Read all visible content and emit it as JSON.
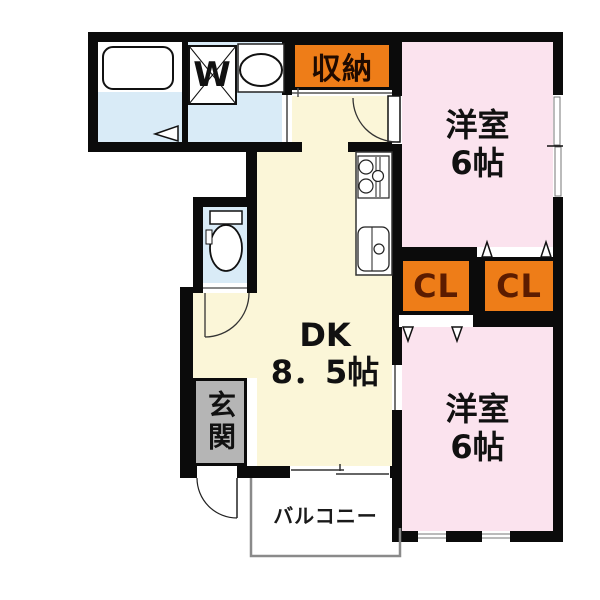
{
  "floorplan": {
    "type": "japanese-apartment-floorplan",
    "colors": {
      "wall": "#0b0b0b",
      "dk_floor": "#fbf6d8",
      "bedroom_floor": "#fbe3ee",
      "wet_area_floor": "#d9ebf7",
      "closet_fill": "#ee7d18",
      "closet_text": "#5c1c00",
      "entrance_fill": "#b5b5b5",
      "balcony_line": "#8a8a8a"
    },
    "rooms": {
      "storage": {
        "label": "収納"
      },
      "laundry": {
        "washer_label": "W"
      },
      "bedroom_top": {
        "label_line1": "洋室",
        "label_line2": "6帖"
      },
      "closet_left": {
        "label": "CL"
      },
      "closet_right": {
        "label": "CL"
      },
      "dk": {
        "label_line1": "DK",
        "label_line2": "8．5帖"
      },
      "bedroom_bottom": {
        "label_line1": "洋室",
        "label_line2": "6帖"
      },
      "entrance": {
        "label": "玄関"
      },
      "balcony": {
        "label": "バルコニー"
      }
    }
  }
}
